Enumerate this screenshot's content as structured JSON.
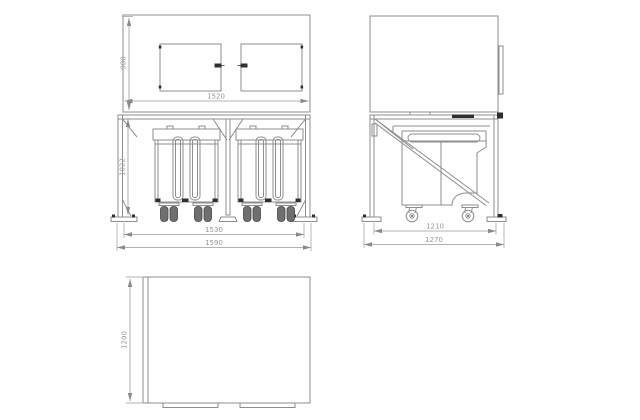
{
  "drawing": {
    "type": "engineering-orthographic-views",
    "views": [
      "front",
      "side",
      "plan"
    ],
    "dims": {
      "front_cabinet_height": "900",
      "front_cabinet_width": "1520",
      "front_frame_height": "1022",
      "front_inner_width": "1530",
      "front_overall_width": "1590",
      "side_inner_depth": "1210",
      "side_overall_depth": "1270",
      "top_depth": "1200"
    },
    "colors": {
      "background": "#ffffff",
      "line": "#8e8e8e",
      "line_dark": "#5f5f5f",
      "fill_dark": "#2f2f2f",
      "dimension": "#9a9a9a"
    }
  }
}
